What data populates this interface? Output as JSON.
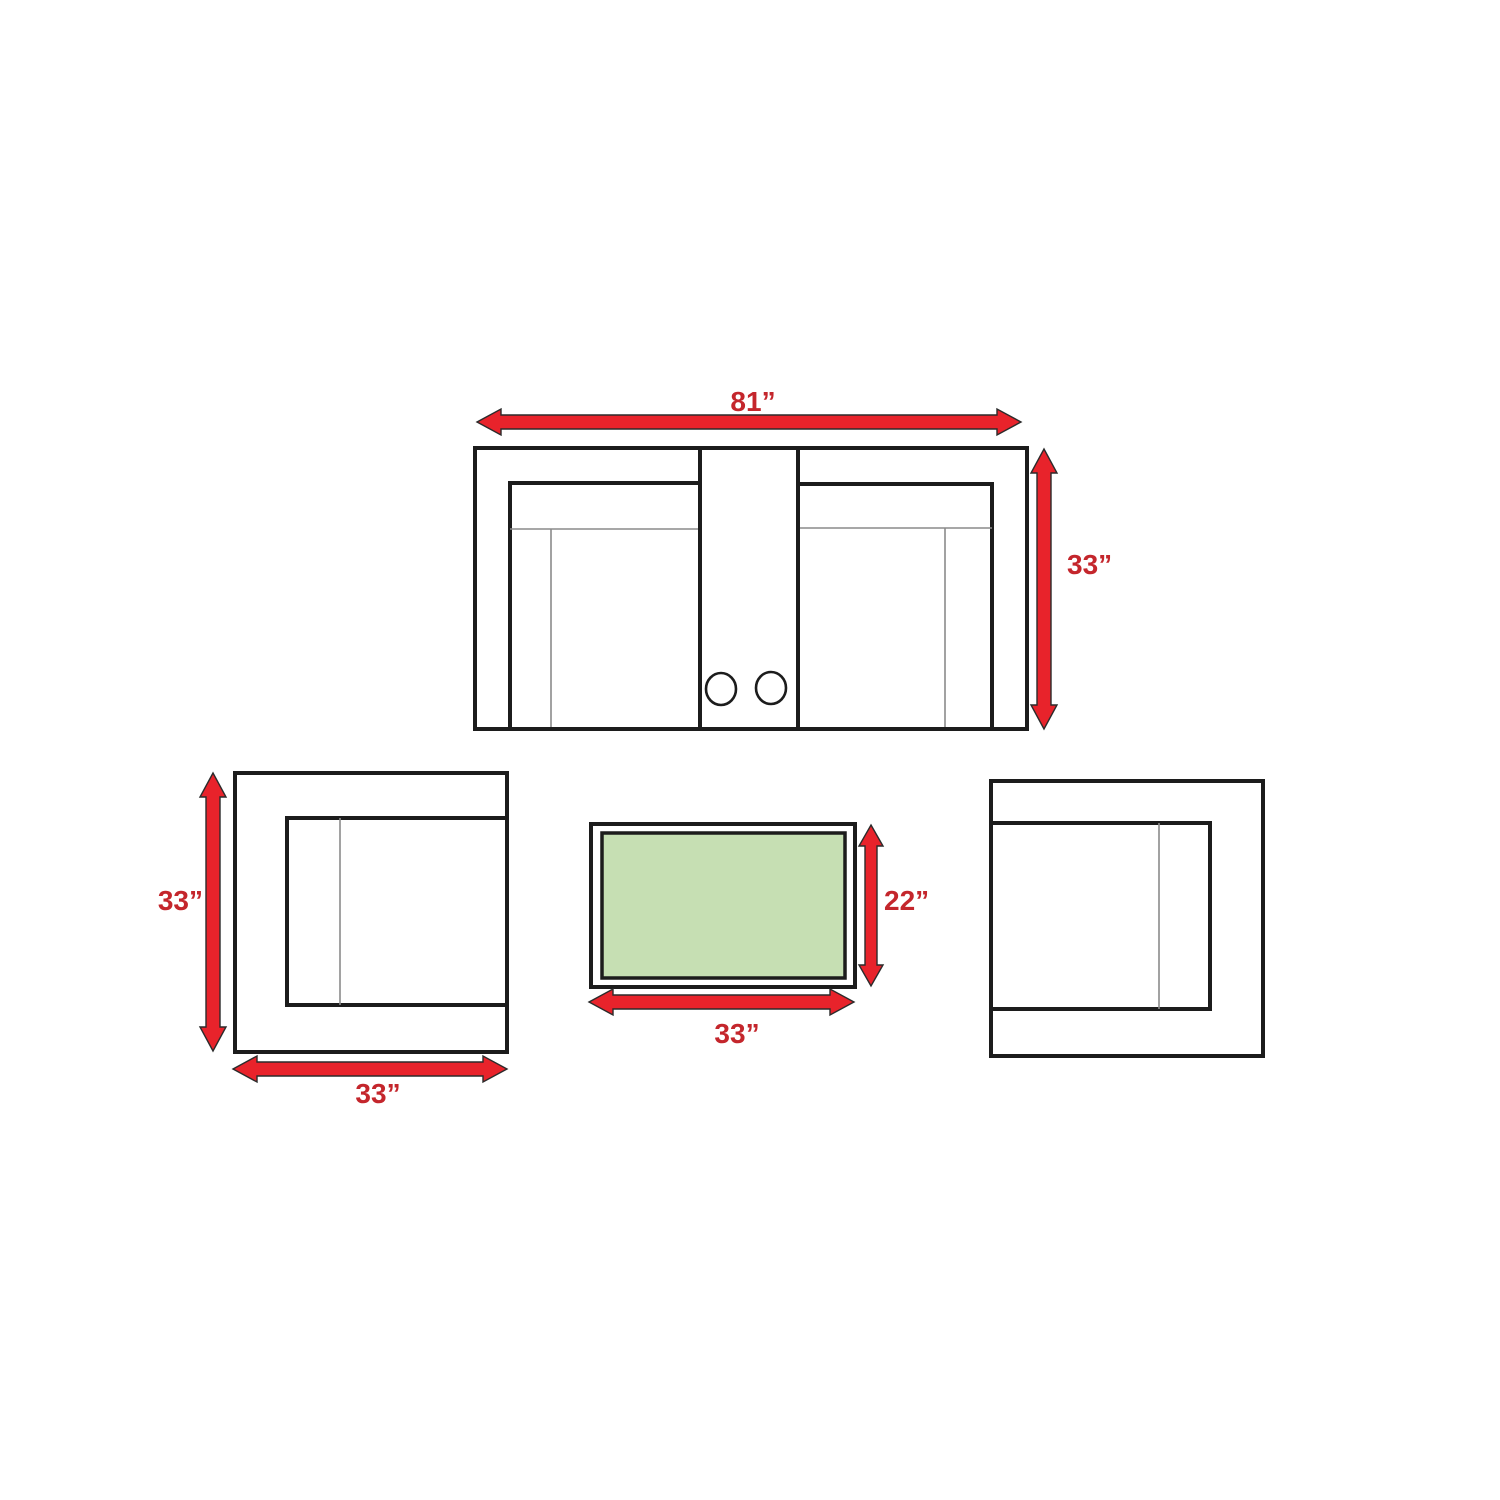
{
  "labels": {
    "sofa_width": "81”",
    "sofa_depth": "33”",
    "chair_depth": "33”",
    "chair_width": "33”",
    "table_height": "22”",
    "table_width": "33”"
  },
  "colors": {
    "arrow_red": "#e8232b",
    "label_red": "#c4262c",
    "outline_black": "#1c1c1c",
    "table_top_green": "#c6dfb3",
    "background": "#ffffff"
  }
}
